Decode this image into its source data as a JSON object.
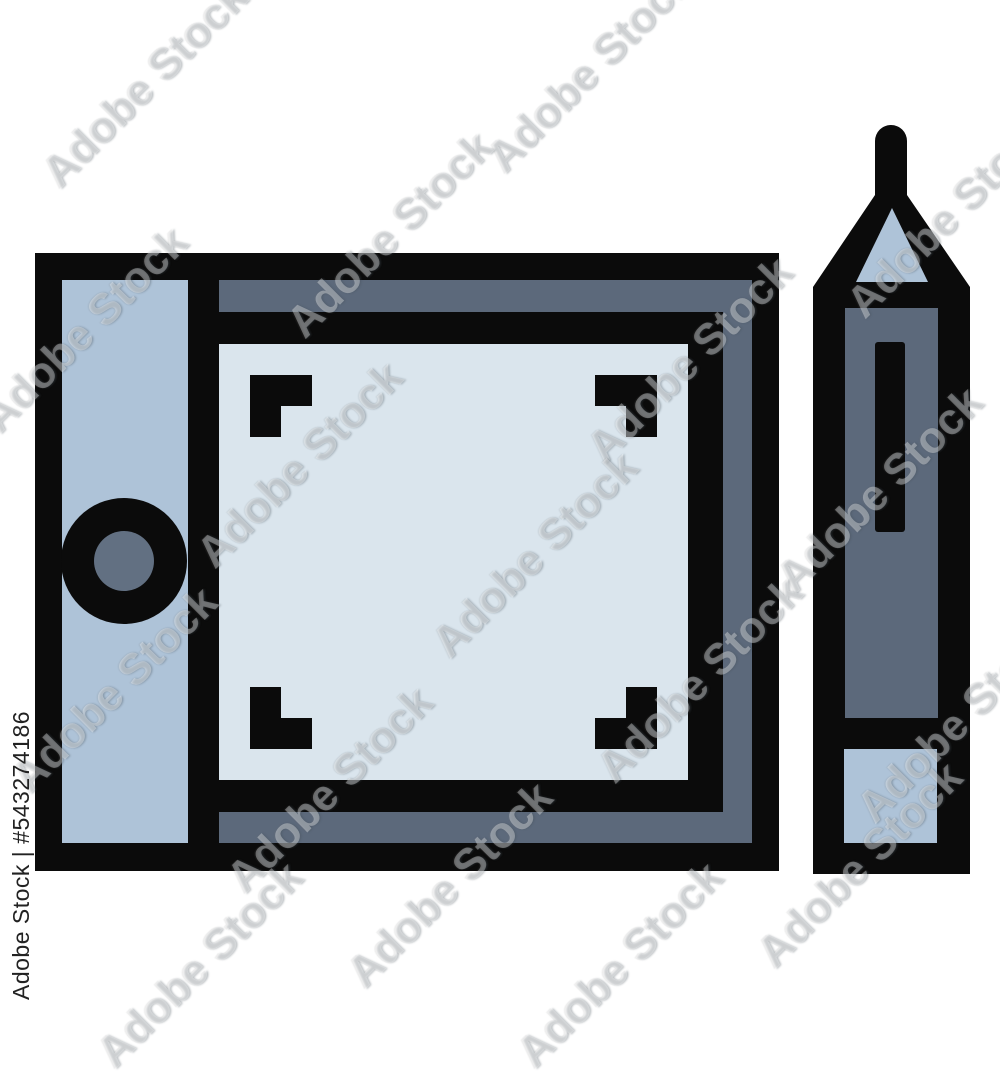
{
  "image": {
    "description": "Stock icon illustration of a pen graphics tablet with stylus",
    "background_color": "#ffffff"
  },
  "watermark": {
    "tile_text": "Adobe Stock",
    "id_text": "Adobe Stock | #543274186",
    "id_color": "#222222",
    "tiles": [
      {
        "x": 145,
        "y": 85
      },
      {
        "x": 590,
        "y": 70
      },
      {
        "x": 950,
        "y": 215
      },
      {
        "x": 85,
        "y": 330
      },
      {
        "x": 390,
        "y": 235
      },
      {
        "x": 300,
        "y": 465
      },
      {
        "x": 690,
        "y": 360
      },
      {
        "x": 535,
        "y": 555
      },
      {
        "x": 115,
        "y": 690
      },
      {
        "x": 880,
        "y": 490
      },
      {
        "x": 330,
        "y": 790
      },
      {
        "x": 700,
        "y": 680
      },
      {
        "x": 450,
        "y": 885
      },
      {
        "x": 860,
        "y": 865
      },
      {
        "x": 200,
        "y": 965
      },
      {
        "x": 620,
        "y": 965
      },
      {
        "x": 960,
        "y": 720
      }
    ]
  },
  "icon": {
    "name": "graphics-tablet-and-stylus",
    "colors": {
      "outline": "#0b0b0b",
      "panel_light": "#aec3d8",
      "surface_lighter": "#dae5ed",
      "slate": "#5c697b",
      "dial_inner": "#627082"
    }
  }
}
